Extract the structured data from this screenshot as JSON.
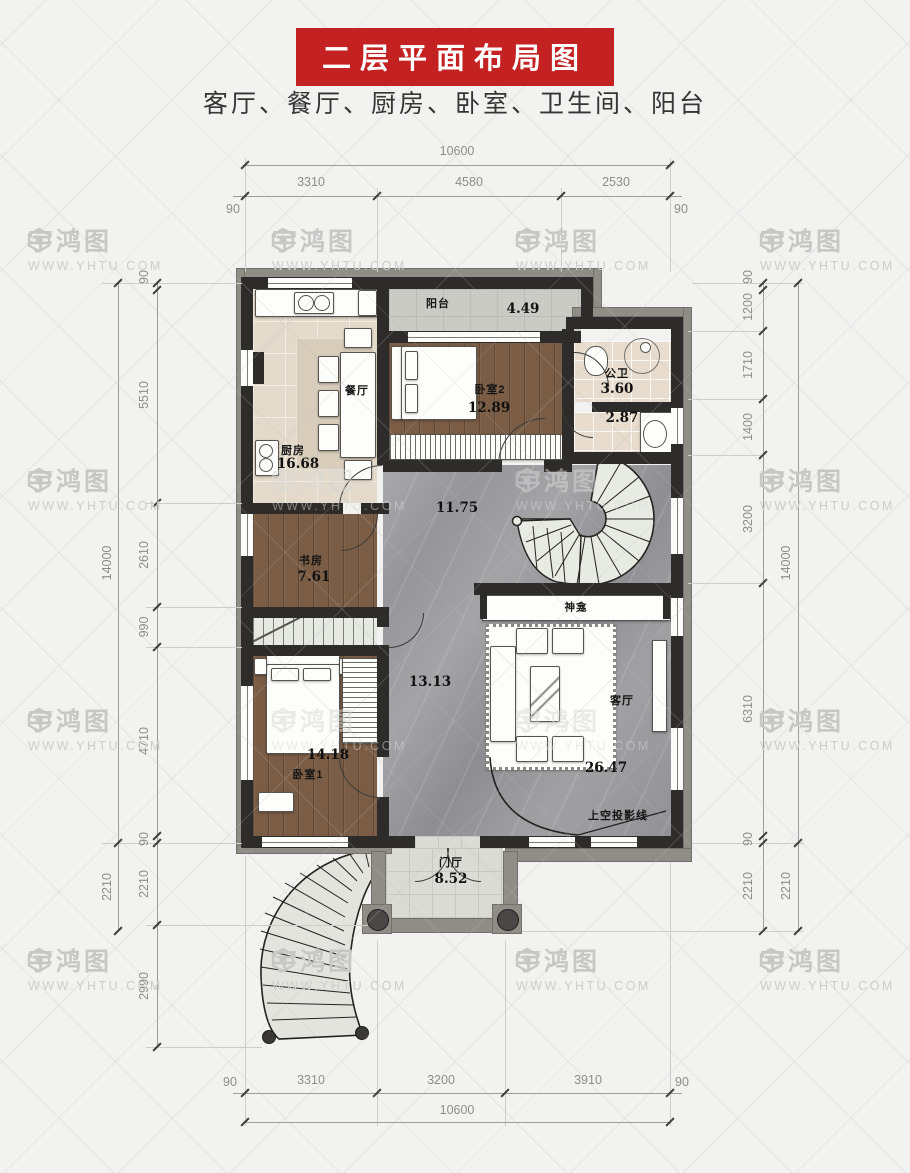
{
  "page": {
    "title": "二层平面布局图",
    "subtitle": "客厅、餐厅、厨房、卧室、卫生间、阳台"
  },
  "watermark": {
    "brand": "宇鸿图",
    "url": "WWW.YHTU.COM"
  },
  "colors": {
    "banner_red": "#c32122",
    "wall_black": "#2e2c2a",
    "wall_gray": "#8f8d85",
    "wood_floor": "#7b5d45",
    "marble_floor": "#9a9a9e",
    "kitchen_tile": "#e4dacb"
  },
  "rooms": {
    "balcony": {
      "name": "阳台",
      "area": "4.49"
    },
    "dining": {
      "name": "餐厅"
    },
    "kitchen": {
      "name": "厨房",
      "area": "16.68"
    },
    "bedroom2": {
      "name": "卧室2",
      "area": "12.89"
    },
    "bath": {
      "name": "公卫",
      "area": "3.60"
    },
    "bath2": {
      "area": "2.87"
    },
    "hall_upper": {
      "area": "11.75"
    },
    "study": {
      "name": "书房",
      "area": "7.61"
    },
    "bedroom1": {
      "name": "卧室1",
      "area": "14.18"
    },
    "hall_lower": {
      "area": "13.13"
    },
    "living": {
      "name": "客厅",
      "area": "26.47"
    },
    "shrine": {
      "name": "神龛"
    },
    "foyer": {
      "name": "门厅",
      "area": "8.52"
    },
    "void_note": "上空投影线"
  },
  "dims": {
    "top": {
      "overall": "10600",
      "segments": [
        "3310",
        "4580",
        "2530"
      ],
      "left_edge": "90",
      "right_edge": "90"
    },
    "bottom": {
      "overall": "10600",
      "segments": [
        "3310",
        "3200",
        "3910"
      ],
      "left_edge": "90",
      "right_edge": "90"
    },
    "left": {
      "outer": [
        "14000",
        "2210"
      ],
      "inner": [
        "90",
        "5510",
        "2610",
        "990",
        "4710",
        "90",
        "2210",
        "2990"
      ]
    },
    "right": {
      "outer": [
        "14000",
        "2210"
      ],
      "inner": [
        "90",
        "1200",
        "1710",
        "1400",
        "3200",
        "6310",
        "90",
        "2210"
      ]
    }
  }
}
